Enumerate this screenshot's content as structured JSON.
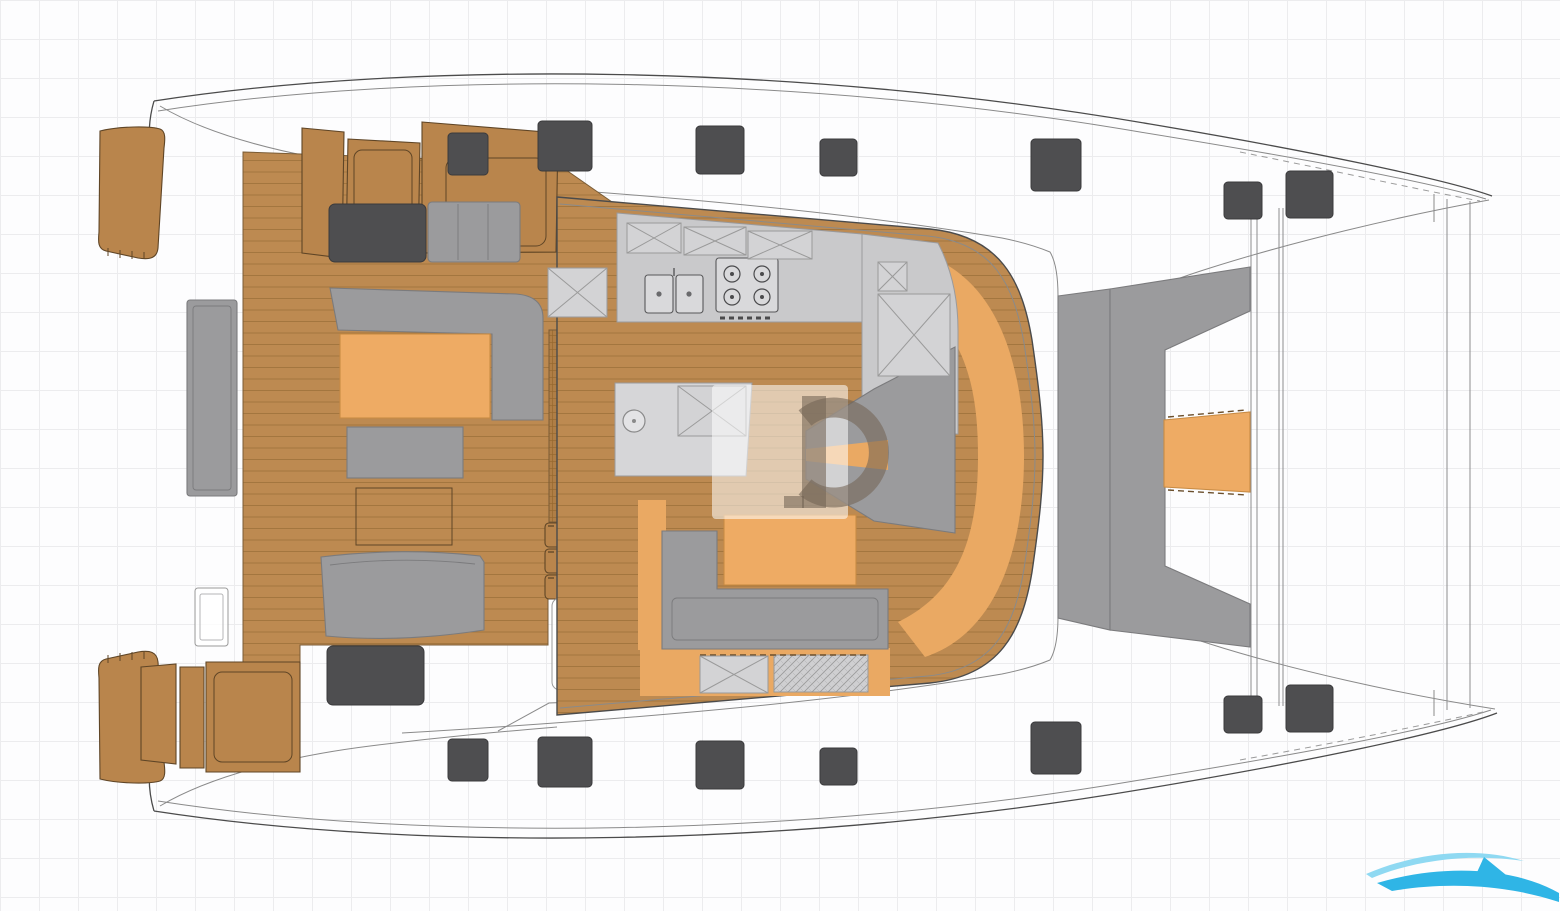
{
  "title_hint": "catamaran-deck-plan-diagram",
  "watermark": {
    "letter": "G"
  },
  "colors": {
    "bg": "#fdfdfe",
    "grid": "#ececee",
    "line": "#4b4b4b",
    "line_light": "#8a8a8a",
    "wood": "#bd8a51",
    "wood_dark": "#a3763f",
    "wood_seat": "#b9854c",
    "wood_edge": "#5f4526",
    "orange": "#eeab64",
    "orange_floor": "#eaa963",
    "orange_edge": "#c88b44",
    "gray_furniture": "#9b9b9d",
    "gray_furniture_edge": "#7b7b7d",
    "counter": "#c9c9cb",
    "counter_light": "#d6d6d8",
    "counter_edge": "#9a9a9c",
    "hatch_dark": "#4e4e50",
    "xbox_fill": "#d3d3d5",
    "xbox_line": "#9a9a9a",
    "watermark_box": "rgba(255,255,255,0.55)",
    "watermark_glyph": "rgba(115,100,84,0.58)",
    "logo_light": "#8fd9f2",
    "logo_blue": "#2fb5e6"
  },
  "deck_hatches": [
    [
      448,
      133,
      40,
      42,
      4
    ],
    [
      538,
      121,
      54,
      50,
      4
    ],
    [
      696,
      126,
      48,
      48,
      4
    ],
    [
      820,
      139,
      37,
      37,
      4
    ],
    [
      1031,
      139,
      50,
      52,
      4
    ],
    [
      1224,
      182,
      38,
      37,
      4
    ],
    [
      1286,
      171,
      47,
      47,
      4
    ],
    [
      448,
      739,
      40,
      42,
      4
    ],
    [
      538,
      737,
      54,
      50,
      4
    ],
    [
      696,
      741,
      48,
      48,
      4
    ],
    [
      820,
      748,
      37,
      37,
      4
    ],
    [
      1031,
      722,
      50,
      52,
      4
    ],
    [
      1224,
      696,
      38,
      37,
      4
    ],
    [
      1286,
      685,
      47,
      47,
      4
    ],
    [
      329,
      204,
      97,
      58,
      6
    ],
    [
      327,
      646,
      97,
      59,
      6
    ]
  ],
  "x_lockers": [
    [
      627,
      223,
      54,
      30
    ],
    [
      684,
      227,
      62,
      28
    ],
    [
      748,
      231,
      64,
      28
    ],
    [
      548,
      268,
      59,
      49
    ],
    [
      678,
      386,
      68,
      50
    ],
    [
      878,
      262,
      29,
      29
    ],
    [
      878,
      294,
      72,
      82
    ],
    [
      700,
      656,
      68,
      37
    ]
  ]
}
